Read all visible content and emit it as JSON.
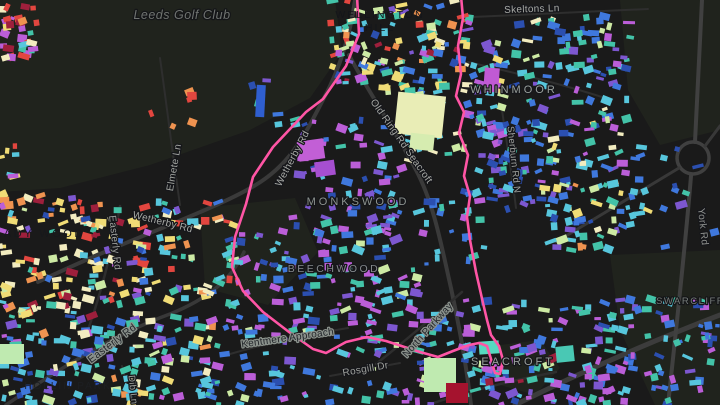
{
  "map": {
    "background": "#1a1a1a",
    "boundary_color": "#ff55a5",
    "park_color": "#20231d",
    "road_color": "#2e2e2e",
    "major_road_color": "#3a3a3a",
    "building_palette": [
      "#e2463f",
      "#ef9350",
      "#f0dc76",
      "#f2ecc0",
      "#cdeaa4",
      "#43c3a8",
      "#57c6dc",
      "#3f78dd",
      "#2b4fb0",
      "#7d57d0",
      "#bb5ed8",
      "#9e1f3c"
    ],
    "poi_labels": [
      {
        "text": "Leeds Golf Club",
        "x": 182,
        "y": 19,
        "rot": 0,
        "size": 12.5,
        "ls": 0.5,
        "color": "#6f7370",
        "halo": "#141518",
        "italic": true,
        "name": "poi-label-leeds-golf-club"
      }
    ],
    "area_labels": [
      {
        "text": "WELLINGTON",
        "x": 380,
        "y": 18,
        "rot": 0,
        "size": 10.5,
        "ls": 2,
        "color": "#14161a",
        "halo": "",
        "name": "area-label-wellington-hill-1"
      },
      {
        "text": "HILL",
        "x": 380,
        "y": 31,
        "rot": 0,
        "size": 10.5,
        "ls": 2,
        "color": "#14161a",
        "halo": "",
        "name": "area-label-wellington-hill-2"
      },
      {
        "text": "WHINMOOR",
        "x": 514,
        "y": 93,
        "rot": 0,
        "size": 11,
        "ls": 3,
        "color": "#9aa09c",
        "halo": "#15161a",
        "name": "area-label-whinmoor"
      },
      {
        "text": "MONKSWOOD",
        "x": 358,
        "y": 205,
        "rot": 0,
        "size": 11,
        "ls": 3,
        "color": "#8d938f",
        "halo": "#141518",
        "name": "area-label-monkswood"
      },
      {
        "text": "BEECHWOOD",
        "x": 334,
        "y": 272,
        "rot": 0,
        "size": 10.5,
        "ls": 2.5,
        "color": "#85898c",
        "halo": "#141518",
        "name": "area-label-beechwood"
      },
      {
        "text": "LADY WOOD",
        "x": 40,
        "y": 237,
        "rot": 0,
        "size": 11,
        "ls": 2.5,
        "color": "#17181c",
        "halo": "",
        "name": "area-label-lady-wood"
      },
      {
        "text": "SEACROFT",
        "x": 513,
        "y": 365,
        "rot": 0,
        "size": 11,
        "ls": 3,
        "color": "#9aa09c",
        "halo": "#15161a",
        "name": "area-label-seacroft"
      },
      {
        "text": "HOLLIN PARK",
        "x": 68,
        "y": 389,
        "rot": 0,
        "size": 10,
        "ls": 2,
        "color": "#1d1f22",
        "halo": "",
        "name": "area-label-hollin-park"
      },
      {
        "text": "SWARCLIFFE",
        "x": 694,
        "y": 304,
        "rot": 0,
        "size": 9.5,
        "ls": 1.5,
        "color": "#777d7a",
        "halo": "#141518",
        "name": "area-label-swarcliffe"
      }
    ],
    "road_labels": [
      {
        "text": "Skeltons Ln",
        "x": 532,
        "y": 12,
        "rot": -2,
        "size": 10,
        "ls": 0.3,
        "color": "#a8aaa6",
        "halo": "#15161a",
        "name": "road-label-skeltons-ln"
      },
      {
        "text": "Elmete Ln",
        "x": 177,
        "y": 168,
        "rot": -80,
        "size": 10,
        "ls": 0.3,
        "color": "#9fa19d",
        "halo": "#15161a",
        "name": "road-label-elmete-ln"
      },
      {
        "text": "Wetherby Rd",
        "x": 295,
        "y": 160,
        "rot": -62,
        "size": 10,
        "ls": 0.3,
        "color": "#a8aaa6",
        "halo": "#15161a",
        "name": "road-label-wetherby-rd-vertical"
      },
      {
        "text": "Wetherby Rd",
        "x": 162,
        "y": 225,
        "rot": 14,
        "size": 10,
        "ls": 0.3,
        "color": "#a8aaa6",
        "halo": "#15161a",
        "name": "road-label-wetherby-rd"
      },
      {
        "text": "Old Ring Rd Seacroft",
        "x": 399,
        "y": 143,
        "rot": 55,
        "size": 10,
        "ls": 0.3,
        "color": "#a8aaa6",
        "halo": "#15161a",
        "name": "road-label-old-ring-rd-seacroft"
      },
      {
        "text": "Sherburn Rd N",
        "x": 511,
        "y": 160,
        "rot": 84,
        "size": 9.5,
        "ls": 0.3,
        "color": "#9fa19d",
        "halo": "#15161a",
        "name": "road-label-sherburn-rd-n"
      },
      {
        "text": "York Rd",
        "x": 700,
        "y": 227,
        "rot": 84,
        "size": 10,
        "ls": 0.3,
        "color": "#8f918e",
        "halo": "#15161a",
        "name": "road-label-york-rd"
      },
      {
        "text": "Easterly Rd",
        "x": 112,
        "y": 243,
        "rot": 84,
        "size": 10,
        "ls": 0.3,
        "color": "#9fa19d",
        "halo": "#15161a",
        "name": "road-label-easterly-rd-vertical"
      },
      {
        "text": "Easterly Rd",
        "x": 114,
        "y": 346,
        "rot": -37,
        "size": 10.5,
        "ls": 0.3,
        "color": "#23262a",
        "halo": "#8b928c",
        "name": "road-label-easterly-rd"
      },
      {
        "text": "Kentmere Approach",
        "x": 288,
        "y": 341,
        "rot": -8,
        "size": 10,
        "ls": 0.3,
        "color": "#22252a",
        "halo": "#8b928c",
        "name": "road-label-kentmere-approach"
      },
      {
        "text": "North Parkway",
        "x": 430,
        "y": 332,
        "rot": -48,
        "size": 10,
        "ls": 0.3,
        "color": "#22252a",
        "halo": "#8b928c",
        "name": "road-label-north-parkway"
      },
      {
        "text": "Rosgill Dr",
        "x": 366,
        "y": 372,
        "rot": -10,
        "size": 10,
        "ls": 0.3,
        "color": "#9fa19d",
        "halo": "#15161a",
        "name": "road-label-rosgill-dr"
      },
      {
        "text": "Dib Ln",
        "x": 130,
        "y": 390,
        "rot": 84,
        "size": 9.5,
        "ls": 0.3,
        "color": "#9fa19d",
        "halo": "#15161a",
        "name": "road-label-dib-ln"
      }
    ],
    "parks": [
      {
        "pts": "0,0 335,0 342,52 310,98 250,130 150,165 60,188 0,192",
        "name": "golf-course-area"
      },
      {
        "pts": "620,0 720,0 720,130 660,145 628,90",
        "name": "field-area-ne"
      },
      {
        "pts": "200,208 295,198 318,252 268,305 205,288",
        "name": "park-area-center"
      },
      {
        "pts": "610,255 720,250 720,405 655,405 620,330",
        "name": "field-area-se"
      },
      {
        "pts": "500,345 540,340 560,368 535,395 500,385",
        "name": "seacroft-green"
      }
    ],
    "roads": [
      {
        "d": "M38,282 C130,238 210,212 254,186 C292,164 306,132 324,98 C340,68 350,36 355,0",
        "w": 4,
        "c": "#3a3a3a"
      },
      {
        "d": "M349,55 C370,95 398,135 416,170 C434,204 441,244 451,288 C459,326 466,362 471,405",
        "w": 4,
        "c": "#3a3a3a"
      },
      {
        "d": "M515,405 C585,370 650,342 720,315",
        "w": 5,
        "c": "#3c3c3c"
      },
      {
        "d": "M702,0 C699,60 697,110 695,142",
        "w": 4,
        "c": "#404040"
      },
      {
        "d": "M691,176 C685,250 676,330 668,405",
        "w": 4,
        "c": "#404040"
      },
      {
        "d": "M693,142 a16,16 0 1,0 0.1,0",
        "w": 3.5,
        "c": "#404040"
      },
      {
        "d": "M556,242 L679,168",
        "w": 3,
        "c": "#383838"
      },
      {
        "d": "M705,146 L720,126",
        "w": 3,
        "c": "#383838"
      },
      {
        "d": "M472,17 L648,9",
        "w": 2,
        "c": "#2e2e2e"
      },
      {
        "d": "M160,58 C166,100 172,150 180,205",
        "w": 2,
        "c": "#2e2e2e"
      },
      {
        "d": "M502,110 C507,145 512,175 516,208",
        "w": 2,
        "c": "#2e2e2e"
      },
      {
        "d": "M6,405 C60,368 120,332 170,314 C210,298 232,278 244,252",
        "w": 3.5,
        "c": "#383838"
      },
      {
        "d": "M120,206 C113,245 102,290 88,330",
        "w": 2.5,
        "c": "#2e2e2e"
      },
      {
        "d": "M230,354 C272,342 310,334 348,328",
        "w": 2,
        "c": "#2e2e2e"
      },
      {
        "d": "M376,364 C404,342 434,316 462,292",
        "w": 2.5,
        "c": "#2e2e2e"
      },
      {
        "d": "M330,376 L400,363",
        "w": 2,
        "c": "#2e2e2e"
      },
      {
        "d": "M122,366 L131,405",
        "w": 2,
        "c": "#2e2e2e"
      },
      {
        "d": "M428,405 C470,390 515,380 556,372",
        "w": 2.5,
        "c": "#2e2e2e"
      },
      {
        "d": "M468,62 C520,74 565,85 605,98",
        "w": 2,
        "c": "#2e2e2e"
      }
    ],
    "boundary_path": "M357,-4 L359,34 L346,66 L323,99 L306,112 L273,147 L253,177 L246,204 L235,237 L232,267 L243,291 L263,312 L289,332 L313,349 L326,353 L346,342 L367,337 L386,341 L420,352 L438,357 L453,351 L469,345 L479,343 L487,346 L491,359 L495,373 L500,374 L503,360 L499,346 L491,335 L487,320 L483,303 L476,272 L470,240 L467,217 L470,196 L464,176 L468,155 L459,133 L464,112 L456,96 L461,74 L458,46 L463,18 L461,-4",
    "clusters": [
      {
        "x": 0,
        "y": 6,
        "w": 40,
        "h": 52,
        "n": 30,
        "wt": [
          4,
          3,
          1,
          1,
          0,
          3,
          2,
          1,
          0,
          2,
          3,
          1
        ]
      },
      {
        "x": 150,
        "y": 90,
        "w": 45,
        "h": 40,
        "n": 6,
        "wt": [
          4,
          3,
          0,
          0,
          0,
          0,
          0,
          0,
          0,
          0,
          1,
          1
        ]
      },
      {
        "x": 0,
        "y": 136,
        "w": 16,
        "h": 42,
        "n": 7,
        "wt": [
          2,
          1,
          2,
          0,
          0,
          0,
          1,
          1,
          0,
          0,
          1,
          0
        ]
      },
      {
        "x": 0,
        "y": 194,
        "w": 150,
        "h": 122,
        "n": 150,
        "wt": [
          3,
          6,
          8,
          6,
          2,
          4,
          2,
          2,
          1,
          1,
          1,
          1
        ]
      },
      {
        "x": 142,
        "y": 202,
        "w": 96,
        "h": 100,
        "n": 55,
        "wt": [
          2,
          2,
          3,
          2,
          1,
          3,
          2,
          2,
          1,
          1,
          1,
          0
        ]
      },
      {
        "x": 0,
        "y": 316,
        "w": 232,
        "h": 89,
        "n": 165,
        "wt": [
          0,
          1,
          1,
          1,
          2,
          5,
          5,
          4,
          2,
          2,
          1,
          0
        ]
      },
      {
        "x": 330,
        "y": 0,
        "w": 140,
        "h": 92,
        "n": 125,
        "wt": [
          2,
          1,
          3,
          2,
          2,
          4,
          4,
          3,
          2,
          2,
          2,
          1
        ]
      },
      {
        "x": 466,
        "y": 20,
        "w": 165,
        "h": 115,
        "n": 115,
        "wt": [
          0,
          0,
          1,
          1,
          2,
          4,
          4,
          4,
          2,
          3,
          2,
          0
        ]
      },
      {
        "x": 560,
        "y": 16,
        "w": 52,
        "h": 30,
        "n": 12,
        "wt": [
          0,
          0,
          0,
          0,
          1,
          3,
          2,
          3,
          1,
          1,
          0,
          0
        ]
      },
      {
        "x": 478,
        "y": 108,
        "w": 72,
        "h": 102,
        "n": 60,
        "wt": [
          0,
          0,
          0,
          0,
          0,
          2,
          2,
          4,
          3,
          3,
          2,
          0
        ]
      },
      {
        "x": 540,
        "y": 132,
        "w": 108,
        "h": 118,
        "n": 90,
        "wt": [
          0,
          1,
          2,
          1,
          2,
          4,
          4,
          2,
          1,
          1,
          1,
          0
        ]
      },
      {
        "x": 292,
        "y": 116,
        "w": 128,
        "h": 118,
        "n": 80,
        "wt": [
          0,
          0,
          0,
          0,
          0,
          1,
          2,
          3,
          2,
          4,
          4,
          0
        ]
      },
      {
        "x": 394,
        "y": 86,
        "w": 72,
        "h": 76,
        "n": 22,
        "wt": [
          0,
          0,
          2,
          4,
          3,
          3,
          1,
          0,
          0,
          0,
          0,
          0
        ]
      },
      {
        "x": 226,
        "y": 230,
        "w": 195,
        "h": 102,
        "n": 125,
        "wt": [
          0,
          0,
          0,
          0,
          1,
          2,
          3,
          3,
          1,
          3,
          5,
          0
        ]
      },
      {
        "x": 420,
        "y": 298,
        "w": 185,
        "h": 107,
        "n": 135,
        "wt": [
          0,
          0,
          0,
          0,
          1,
          3,
          3,
          3,
          1,
          3,
          5,
          1
        ]
      },
      {
        "x": 230,
        "y": 328,
        "w": 205,
        "h": 77,
        "n": 70,
        "wt": [
          0,
          0,
          0,
          0,
          1,
          3,
          4,
          3,
          1,
          2,
          3,
          0
        ]
      },
      {
        "x": 598,
        "y": 292,
        "w": 122,
        "h": 113,
        "n": 75,
        "wt": [
          0,
          0,
          0,
          0,
          0,
          3,
          3,
          4,
          2,
          2,
          3,
          0
        ]
      },
      {
        "x": 628,
        "y": 148,
        "w": 92,
        "h": 105,
        "n": 10,
        "wt": [
          0,
          0,
          0,
          0,
          0,
          3,
          1,
          3,
          1,
          1,
          1,
          0
        ]
      },
      {
        "x": 418,
        "y": 192,
        "w": 66,
        "h": 72,
        "n": 26,
        "wt": [
          0,
          0,
          0,
          0,
          0,
          3,
          2,
          3,
          1,
          1,
          1,
          0
        ]
      },
      {
        "x": 250,
        "y": 80,
        "w": 30,
        "h": 48,
        "n": 5,
        "wt": [
          0,
          0,
          0,
          0,
          0,
          1,
          1,
          3,
          1,
          1,
          0,
          0
        ]
      }
    ],
    "special_buildings": [
      {
        "x": 396,
        "y": 94,
        "w": 48,
        "h": 42,
        "rot": 6,
        "c": "#e9edb6"
      },
      {
        "x": 410,
        "y": 134,
        "w": 24,
        "h": 16,
        "rot": 6,
        "c": "#d6ecb0"
      },
      {
        "x": 424,
        "y": 358,
        "w": 32,
        "h": 34,
        "rot": 0,
        "c": "#bfeab0"
      },
      {
        "x": 0,
        "y": 344,
        "w": 24,
        "h": 20,
        "rot": 0,
        "c": "#bfeab0"
      },
      {
        "x": 479,
        "y": 341,
        "w": 20,
        "h": 13,
        "rot": -4,
        "c": "#56d9c0"
      },
      {
        "x": 446,
        "y": 383,
        "w": 22,
        "h": 20,
        "rot": 0,
        "c": "#a5132e"
      },
      {
        "x": 298,
        "y": 140,
        "w": 26,
        "h": 20,
        "rot": -8,
        "c": "#c25fd6"
      },
      {
        "x": 315,
        "y": 161,
        "w": 20,
        "h": 15,
        "rot": -8,
        "c": "#a64fd0"
      },
      {
        "x": 484,
        "y": 68,
        "w": 15,
        "h": 24,
        "rot": 4,
        "c": "#c05ad4"
      },
      {
        "x": 256,
        "y": 85,
        "w": 9,
        "h": 32,
        "rot": 3,
        "c": "#2f5fd0"
      },
      {
        "x": 556,
        "y": 346,
        "w": 18,
        "h": 16,
        "rot": -6,
        "c": "#49c8b4"
      }
    ]
  }
}
